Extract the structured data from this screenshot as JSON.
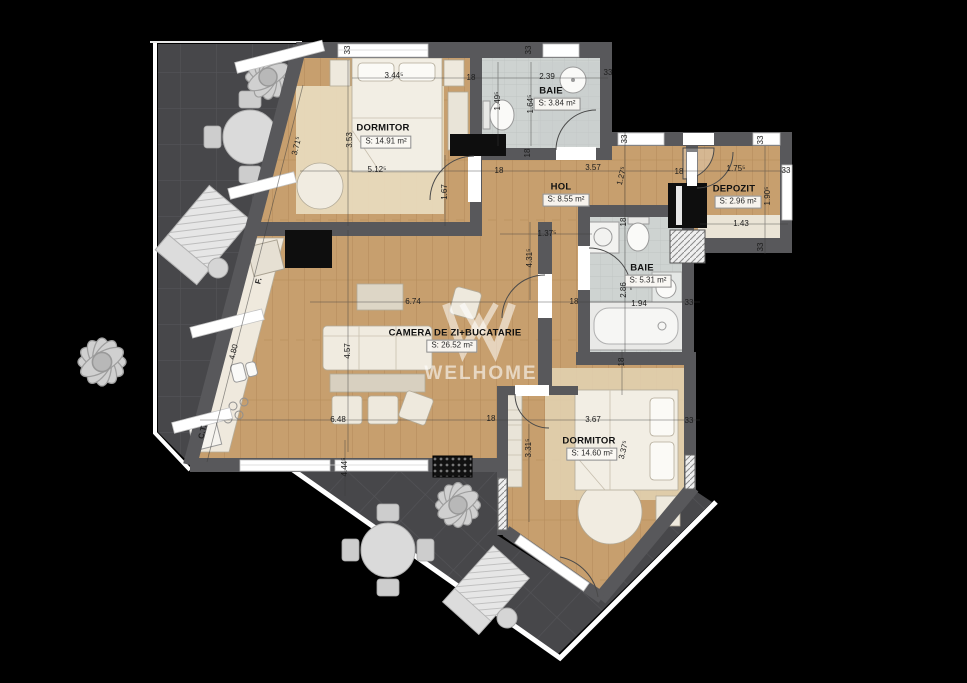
{
  "watermark": {
    "logo": "W-chevron",
    "text": "WELHOME"
  },
  "rooms": [
    {
      "id": "dormitor-1",
      "name": "DORMITOR",
      "area": "S: 14.91 m²",
      "nx": 383,
      "ny": 128,
      "ax": 386,
      "ay": 142
    },
    {
      "id": "baie-1",
      "name": "BAIE",
      "area": "S: 3.84 m²",
      "nx": 551,
      "ny": 91,
      "ax": 557,
      "ay": 104
    },
    {
      "id": "hol",
      "name": "HOL",
      "area": "S: 8.55 m²",
      "nx": 561,
      "ny": 187,
      "ax": 566,
      "ay": 200
    },
    {
      "id": "depozit",
      "name": "DEPOZIT",
      "area": "S: 2.96 m²",
      "nx": 734,
      "ny": 189,
      "ax": 738,
      "ay": 202
    },
    {
      "id": "baie-2",
      "name": "BAIE",
      "area": "S: 5.31 m²",
      "nx": 642,
      "ny": 268,
      "ax": 648,
      "ay": 281
    },
    {
      "id": "camera-de-zi-bucatarie",
      "name": "CAMERA DE ZI+BUCATARIE",
      "area": "S: 26.52 m²",
      "nx": 455,
      "ny": 333,
      "ax": 452,
      "ay": 346
    },
    {
      "id": "dormitor-2",
      "name": "DORMITOR",
      "area": "S: 14.60 m²",
      "nx": 589,
      "ny": 441,
      "ax": 592,
      "ay": 454
    }
  ],
  "dimensions": [
    {
      "text": "33",
      "x": 348,
      "y": 50,
      "r": -90
    },
    {
      "text": "3.44⁵",
      "x": 394,
      "y": 76,
      "r": 0
    },
    {
      "text": "18",
      "x": 471,
      "y": 78,
      "r": 0
    },
    {
      "text": "33",
      "x": 529,
      "y": 50,
      "r": -90
    },
    {
      "text": "2.39",
      "x": 547,
      "y": 77,
      "r": 0
    },
    {
      "text": "33",
      "x": 608,
      "y": 73,
      "r": 0
    },
    {
      "text": "1.49⁵",
      "x": 498,
      "y": 101,
      "r": -90
    },
    {
      "text": "1.64⁵",
      "x": 531,
      "y": 104,
      "r": -90
    },
    {
      "text": "3.53",
      "x": 350,
      "y": 140,
      "r": -90
    },
    {
      "text": "3.71⁵",
      "x": 297,
      "y": 146,
      "r": -76
    },
    {
      "text": "5.12⁵",
      "x": 377,
      "y": 170,
      "r": 0
    },
    {
      "text": "18",
      "x": 499,
      "y": 171,
      "r": 0
    },
    {
      "text": "1.67",
      "x": 445,
      "y": 192,
      "r": -90
    },
    {
      "text": "18",
      "x": 528,
      "y": 153,
      "r": -90
    },
    {
      "text": "3.57",
      "x": 593,
      "y": 168,
      "r": 0
    },
    {
      "text": "1.27⁵",
      "x": 622,
      "y": 176,
      "r": -76
    },
    {
      "text": "18",
      "x": 679,
      "y": 172,
      "r": 0
    },
    {
      "text": "1.75⁵",
      "x": 736,
      "y": 169,
      "r": 0
    },
    {
      "text": "33",
      "x": 786,
      "y": 171,
      "r": 0
    },
    {
      "text": "33",
      "x": 625,
      "y": 139,
      "r": -90
    },
    {
      "text": "33",
      "x": 761,
      "y": 140,
      "r": -90
    },
    {
      "text": "1.90⁵",
      "x": 768,
      "y": 196,
      "r": -90
    },
    {
      "text": "1.43",
      "x": 741,
      "y": 224,
      "r": 0
    },
    {
      "text": "33",
      "x": 761,
      "y": 247,
      "r": -90
    },
    {
      "text": "1.37⁵",
      "x": 547,
      "y": 234,
      "r": 0
    },
    {
      "text": "4.31⁵",
      "x": 530,
      "y": 258,
      "r": -90
    },
    {
      "text": "18",
      "x": 624,
      "y": 222,
      "r": -90
    },
    {
      "text": "2.86",
      "x": 624,
      "y": 290,
      "r": -90
    },
    {
      "text": "1.94",
      "x": 639,
      "y": 304,
      "r": 0
    },
    {
      "text": "33",
      "x": 689,
      "y": 303,
      "r": 0
    },
    {
      "text": "18",
      "x": 574,
      "y": 302,
      "r": 0
    },
    {
      "text": "6.74",
      "x": 413,
      "y": 302,
      "r": 0
    },
    {
      "text": "4.57",
      "x": 348,
      "y": 351,
      "r": -90
    },
    {
      "text": "6.48",
      "x": 338,
      "y": 420,
      "r": 0
    },
    {
      "text": "18",
      "x": 491,
      "y": 419,
      "r": 0
    },
    {
      "text": "3.67",
      "x": 593,
      "y": 420,
      "r": 0
    },
    {
      "text": "33",
      "x": 689,
      "y": 421,
      "r": 0
    },
    {
      "text": "3.31⁵",
      "x": 529,
      "y": 448,
      "r": -90
    },
    {
      "text": "3.37⁵",
      "x": 624,
      "y": 450,
      "r": -76
    },
    {
      "text": "4.80",
      "x": 234,
      "y": 352,
      "r": -76
    },
    {
      "text": "18",
      "x": 622,
      "y": 362,
      "r": -90
    },
    {
      "text": "4.44⁵",
      "x": 345,
      "y": 467,
      "r": -90
    }
  ],
  "annotations": [
    {
      "text": "F.",
      "x": 259,
      "y": 281,
      "r": -76
    },
    {
      "text": "C.T.",
      "x": 203,
      "y": 432,
      "r": -76
    }
  ],
  "colors": {
    "background": "#000000",
    "terrace": "#47474a",
    "terrace_grid": "#545458",
    "wall": "#58585b",
    "wood_floor": "#c79f6e",
    "bath_tile": "#ced3d1",
    "rug_beige": "#e8dabc",
    "furniture_cream": "#eee9dd",
    "watermark_white": "rgba(255,255,255,0.58)"
  }
}
